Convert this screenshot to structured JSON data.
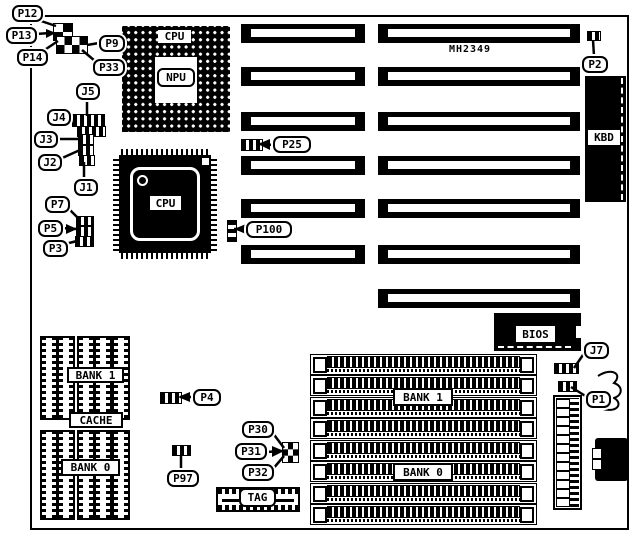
{
  "board": {
    "model": "MH2349"
  },
  "callouts": {
    "p12": "P12",
    "p13": "P13",
    "p14": "P14",
    "p9": "P9",
    "p33": "P33",
    "j5": "J5",
    "j4": "J4",
    "j3": "J3",
    "j2": "J2",
    "j1": "J1",
    "p7": "P7",
    "p5": "P5",
    "p3": "P3",
    "p25": "P25",
    "p100": "P100",
    "p2": "P2",
    "j7": "J7",
    "p1": "P1",
    "p4": "P4",
    "p97": "P97",
    "p30": "P30",
    "p31": "P31",
    "p32": "P32"
  },
  "chips": {
    "cpu_socket": "CPU",
    "npu": "NPU",
    "cpu_qfp": "CPU",
    "kbd": "KBD",
    "bios": "BIOS",
    "tag": "TAG"
  },
  "cache": {
    "bank1": "BANK 1",
    "label": "CACHE",
    "bank0": "BANK 0"
  },
  "memory": {
    "bank1": "BANK 1",
    "bank0": "BANK 0"
  }
}
